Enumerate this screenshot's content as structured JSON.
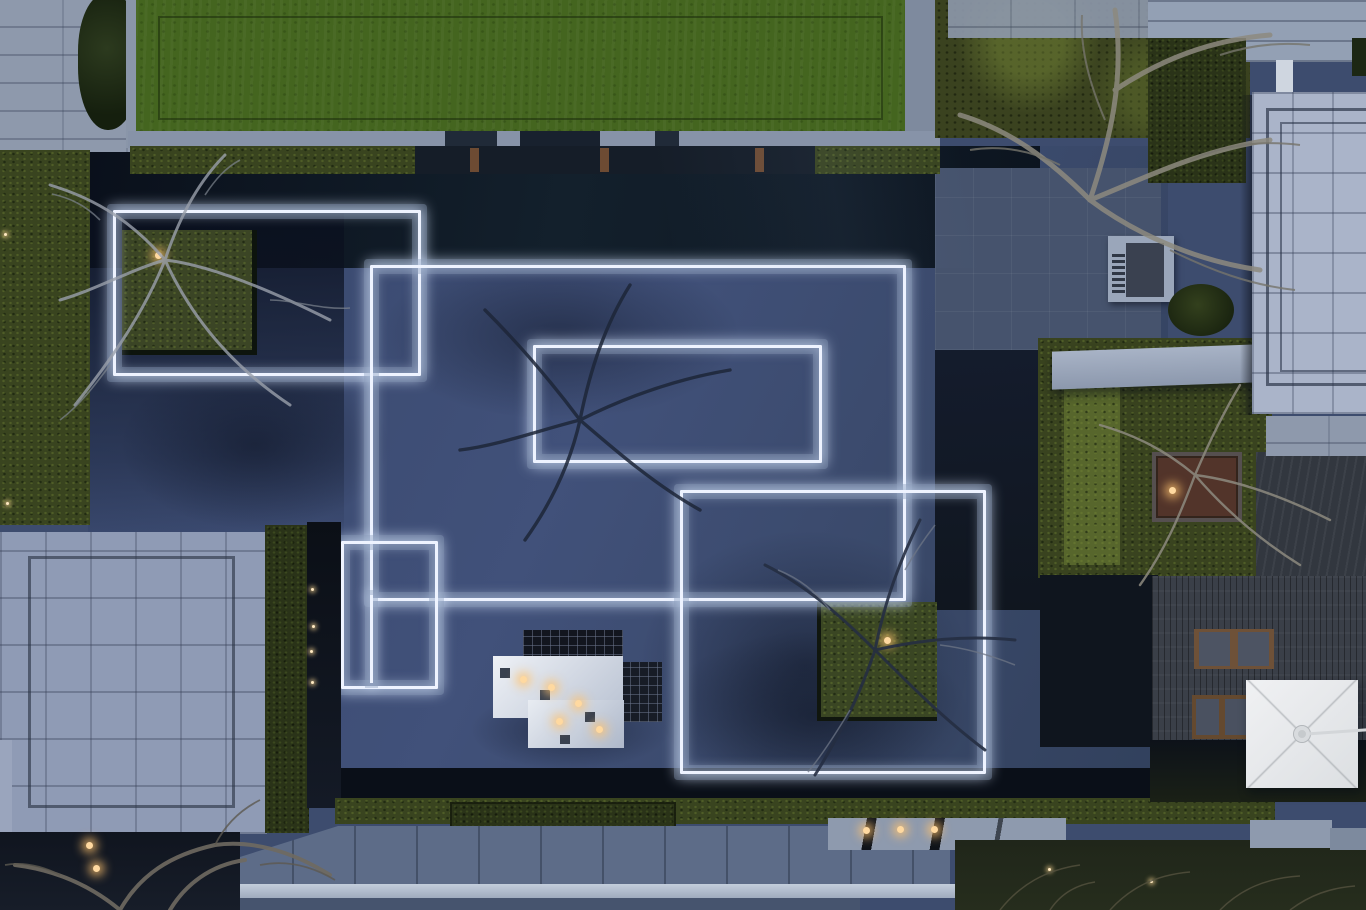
{
  "scene": {
    "description": "Dusk aerial drone photograph of a minimalist landscaped courtyard: glowing white rectangular light lines embedded in dark slate paving, a green lawn roof, clipped hedges, square tree planters, a mirrored-cube pavilion, stone walkways, a timber deck with loungers and a white square parasol.",
    "time_of_day": "dusk",
    "view": "top-down aerial",
    "palette": {
      "courtyard_slate": "#3d4c6e",
      "water_dark": "#0d151f",
      "light_line_white": "#eef3ff",
      "light_line_halo": "#8a9ab8",
      "lawn_green": "#44651f",
      "hedge_olive": "#39441f",
      "hedge_dark_olive": "#2a3318",
      "paver_gray": "#8e99ac",
      "roof_light": "#aab4c9",
      "deck_wood": "#3a3f48",
      "umbrella_white": "#e7e9eb",
      "warm_light": "#ffd9a0",
      "earth_dark": "#232a1c"
    },
    "light_rectangles": [
      {
        "name": "left-rectangle",
        "x": 113,
        "y": 210,
        "w": 302,
        "h": 160
      },
      {
        "name": "large-rectangle",
        "x": 370,
        "y": 265,
        "w": 530,
        "h": 330
      },
      {
        "name": "inner-rectangle",
        "x": 533,
        "y": 345,
        "w": 283,
        "h": 112
      },
      {
        "name": "right-rectangle",
        "x": 680,
        "y": 490,
        "w": 300,
        "h": 278
      },
      {
        "name": "small-rectangle",
        "x": 341,
        "y": 541,
        "w": 91,
        "h": 142
      }
    ],
    "features": [
      {
        "name": "top-left-paver-plaza",
        "color": "#8e99ac"
      },
      {
        "name": "lawn-roof",
        "color": "#44651f"
      },
      {
        "name": "reflecting-water-band",
        "color": "#0d151f"
      },
      {
        "name": "left-tree-planter",
        "color": "#3b4525",
        "light": "warm"
      },
      {
        "name": "right-tree-planter",
        "color": "#3a4623",
        "light": "warm"
      },
      {
        "name": "mirrored-cube-pavilion",
        "colors": [
          "#e9edf3",
          "#12161f"
        ],
        "lights": "warm interior glow"
      },
      {
        "name": "bottom-left-building-roof",
        "color": "#8f9bb5"
      },
      {
        "name": "right-building-roof",
        "color": "#aab4c9"
      },
      {
        "name": "stone-bench",
        "color": "#9aa6ba"
      },
      {
        "name": "right-garden-hedges",
        "color": "#39431f"
      },
      {
        "name": "timber-deck",
        "color": "#3a3f48"
      },
      {
        "name": "lounge-chairs",
        "count": 2
      },
      {
        "name": "white-square-parasol",
        "color": "#e7e9eb"
      },
      {
        "name": "south-walkway",
        "color": "#b7c1d0",
        "path_lights": 3
      },
      {
        "name": "bare-winter-trees",
        "color": "#9aa0ab"
      }
    ]
  }
}
